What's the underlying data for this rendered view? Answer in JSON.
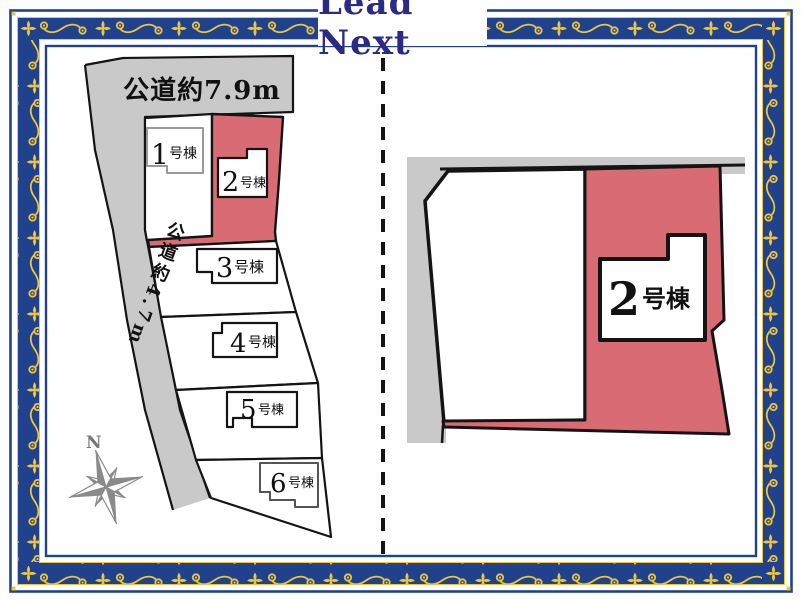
{
  "header": {
    "title": "Lead Next"
  },
  "left_panel": {
    "road_top_label": "公道約7.9m",
    "road_left_label": "公道約4.7m",
    "compass_north_label": "N",
    "plots": [
      {
        "number": "1",
        "suffix": "号棟",
        "highlighted": false
      },
      {
        "number": "2",
        "suffix": "号棟",
        "highlighted": true
      },
      {
        "number": "3",
        "suffix": "号棟",
        "highlighted": false
      },
      {
        "number": "4",
        "suffix": "号棟",
        "highlighted": false
      },
      {
        "number": "5",
        "suffix": "号棟",
        "highlighted": false
      },
      {
        "number": "6",
        "suffix": "号棟",
        "highlighted": false
      }
    ]
  },
  "right_panel": {
    "plot": {
      "number": "2",
      "suffix": "号棟"
    }
  },
  "colors": {
    "border_navy": "#20428c",
    "ornament_gold": "#f0c53a",
    "highlight_pink": "#d96b75",
    "road_gray": "#c9c9c9",
    "title_navy": "#2b2a85"
  }
}
